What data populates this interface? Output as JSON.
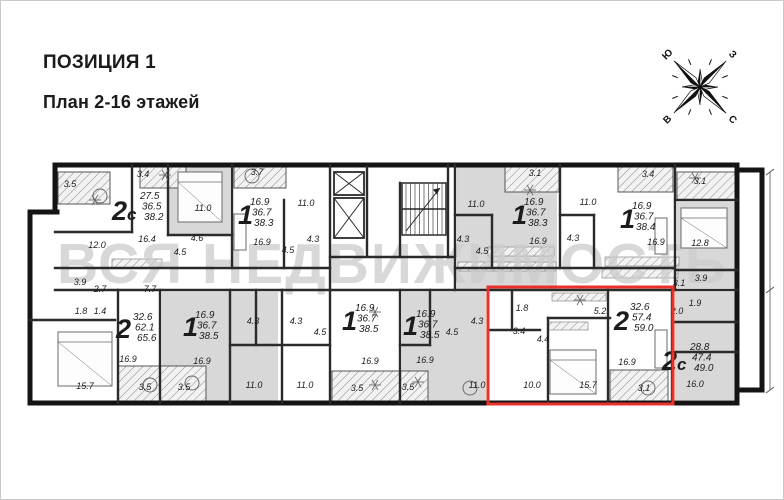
{
  "header": {
    "title": "ПОЗИЦИЯ 1",
    "subtitle": "План 2-16 этажей"
  },
  "watermark": {
    "text": "ВСЯ НЕДВИЖИМОСТЬ"
  },
  "compass": {
    "letters": [
      {
        "t": "Ю",
        "a": 315
      },
      {
        "t": "З",
        "a": 45
      },
      {
        "t": "В",
        "a": 225
      },
      {
        "t": "С",
        "a": 135
      }
    ]
  },
  "colors": {
    "wall": "#141414",
    "thin": "#2a2a2a",
    "room_shade": "#d8d8d8",
    "hatch": "#8a8a8a",
    "red": "#e8312a",
    "watermark": "#cccccc",
    "label": "#1c1c1c",
    "furn": "#6a6a6a"
  },
  "plan": {
    "highlight": {
      "x": 488,
      "y": 287,
      "w": 185,
      "h": 117
    },
    "apartments": [
      {
        "id": "apt-2c-top-left",
        "type": "2с",
        "tx": 112,
        "ty": 220,
        "ax": 140,
        "ay": 199,
        "areas": [
          "27.5",
          "36.5",
          "38.2"
        ]
      },
      {
        "id": "apt-1-top-2",
        "type": "1",
        "tx": 238,
        "ty": 224,
        "ax": 250,
        "ay": 205,
        "areas": [
          "16.9",
          "36.7",
          "38.3"
        ]
      },
      {
        "id": "apt-1-top-3",
        "type": "1",
        "tx": 512,
        "ty": 224,
        "ax": 524,
        "ay": 205,
        "areas": [
          "16.9",
          "36.7",
          "38.3"
        ]
      },
      {
        "id": "apt-1-top-4",
        "type": "1",
        "tx": 620,
        "ty": 228,
        "ax": 632,
        "ay": 209,
        "areas": [
          "16.9",
          "36.7",
          "38.4"
        ]
      },
      {
        "id": "apt-2c-right",
        "type": "2с",
        "tx": 662,
        "ty": 370,
        "ax": 690,
        "ay": 350,
        "areas": [
          "28.8",
          "47.4",
          "49.0"
        ]
      },
      {
        "id": "apt-2-bottom-left",
        "type": "2",
        "tx": 116,
        "ty": 338,
        "ax": 133,
        "ay": 320,
        "areas": [
          "32.6",
          "62.1",
          "65.6"
        ]
      },
      {
        "id": "apt-1-bottom-1",
        "type": "1",
        "tx": 183,
        "ty": 336,
        "ax": 195,
        "ay": 318,
        "areas": [
          "16.9",
          "36.7",
          "38.5"
        ]
      },
      {
        "id": "apt-1-bottom-2",
        "type": "1",
        "tx": 342,
        "ty": 330,
        "ax": 355,
        "ay": 311,
        "areas": [
          "16.9",
          "36.7",
          "38.5"
        ]
      },
      {
        "id": "apt-1-bottom-3",
        "type": "1",
        "tx": 403,
        "ty": 335,
        "ax": 416,
        "ay": 317,
        "areas": [
          "16.9",
          "36.7",
          "38.5"
        ]
      },
      {
        "id": "apt-2-highlighted",
        "type": "2",
        "tx": 614,
        "ty": 330,
        "ax": 630,
        "ay": 310,
        "areas": [
          "32.6",
          "57.4",
          "59.0"
        ]
      }
    ],
    "room_labels": [
      {
        "t": "3.5",
        "x": 70,
        "y": 187
      },
      {
        "t": "3.4",
        "x": 143,
        "y": 177
      },
      {
        "t": "11.0",
        "x": 203,
        "y": 211
      },
      {
        "t": "12.0",
        "x": 97,
        "y": 248
      },
      {
        "t": "16.4",
        "x": 147,
        "y": 242
      },
      {
        "t": "4.6",
        "x": 197,
        "y": 241
      },
      {
        "t": "4.5",
        "x": 180,
        "y": 255
      },
      {
        "t": "3.7",
        "x": 257,
        "y": 175
      },
      {
        "t": "11.0",
        "x": 306,
        "y": 206
      },
      {
        "t": "16.9",
        "x": 262,
        "y": 245
      },
      {
        "t": "4.3",
        "x": 313,
        "y": 242
      },
      {
        "t": "4.5",
        "x": 288,
        "y": 253
      },
      {
        "t": "3.1",
        "x": 535,
        "y": 176
      },
      {
        "t": "11.0",
        "x": 476,
        "y": 207
      },
      {
        "t": "4.3",
        "x": 463,
        "y": 242
      },
      {
        "t": "4.5",
        "x": 482,
        "y": 254
      },
      {
        "t": "16.9",
        "x": 538,
        "y": 244
      },
      {
        "t": "3.4",
        "x": 648,
        "y": 177
      },
      {
        "t": "11.0",
        "x": 588,
        "y": 205
      },
      {
        "t": "4.3",
        "x": 573,
        "y": 241
      },
      {
        "t": "16.9",
        "x": 656,
        "y": 245
      },
      {
        "t": "3.1",
        "x": 700,
        "y": 184
      },
      {
        "t": "12.8",
        "x": 700,
        "y": 246
      },
      {
        "t": "3.9",
        "x": 701,
        "y": 281
      },
      {
        "t": "3.9",
        "x": 80,
        "y": 285
      },
      {
        "t": "2.7",
        "x": 100,
        "y": 292
      },
      {
        "t": "7.7",
        "x": 150,
        "y": 292
      },
      {
        "t": "1.8",
        "x": 81,
        "y": 314
      },
      {
        "t": "1.4",
        "x": 100,
        "y": 314
      },
      {
        "t": "15.7",
        "x": 85,
        "y": 389
      },
      {
        "t": "16.9",
        "x": 128,
        "y": 362
      },
      {
        "t": "3.5",
        "x": 145,
        "y": 390
      },
      {
        "t": "16.9",
        "x": 202,
        "y": 364
      },
      {
        "t": "3.5",
        "x": 184,
        "y": 390
      },
      {
        "t": "4.3",
        "x": 253,
        "y": 324
      },
      {
        "t": "4.3",
        "x": 296,
        "y": 324
      },
      {
        "t": "4.5",
        "x": 320,
        "y": 335
      },
      {
        "t": "11.0",
        "x": 254,
        "y": 388
      },
      {
        "t": "11.0",
        "x": 305,
        "y": 388
      },
      {
        "t": "16.9",
        "x": 370,
        "y": 364
      },
      {
        "t": "3.5",
        "x": 357,
        "y": 391
      },
      {
        "t": "3.5",
        "x": 408,
        "y": 390
      },
      {
        "t": "4.3",
        "x": 477,
        "y": 324
      },
      {
        "t": "4.5",
        "x": 452,
        "y": 335
      },
      {
        "t": "16.9",
        "x": 425,
        "y": 363
      },
      {
        "t": "11.0",
        "x": 477,
        "y": 388
      },
      {
        "t": "1.8",
        "x": 522,
        "y": 311
      },
      {
        "t": "3.4",
        "x": 519,
        "y": 334
      },
      {
        "t": "4.4",
        "x": 543,
        "y": 342
      },
      {
        "t": "5.2",
        "x": 600,
        "y": 314
      },
      {
        "t": "10.0",
        "x": 532,
        "y": 388
      },
      {
        "t": "15.7",
        "x": 588,
        "y": 388
      },
      {
        "t": "16.9",
        "x": 627,
        "y": 365
      },
      {
        "t": "3.1",
        "x": 644,
        "y": 391
      },
      {
        "t": "3.1",
        "x": 679,
        "y": 286
      },
      {
        "t": "1.9",
        "x": 695,
        "y": 306
      },
      {
        "t": "2.0",
        "x": 677,
        "y": 314
      },
      {
        "t": "16.0",
        "x": 695,
        "y": 387
      }
    ],
    "gray_rooms": [
      [
        168,
        167,
        62,
        67
      ],
      [
        457,
        167,
        100,
        122
      ],
      [
        677,
        202,
        58,
        86
      ],
      [
        675,
        292,
        60,
        108
      ],
      [
        162,
        292,
        116,
        110
      ],
      [
        402,
        292,
        84,
        110
      ]
    ],
    "balconies": [
      [
        58,
        172,
        52,
        32
      ],
      [
        140,
        166,
        46,
        22
      ],
      [
        234,
        166,
        52,
        22
      ],
      [
        505,
        166,
        54,
        26
      ],
      [
        618,
        166,
        55,
        26
      ],
      [
        677,
        172,
        58,
        28
      ],
      [
        118,
        366,
        88,
        37
      ],
      [
        332,
        371,
        96,
        32
      ],
      [
        610,
        370,
        58,
        33
      ]
    ],
    "hatch_strips": [
      [
        112,
        259,
        50,
        9
      ],
      [
        488,
        247,
        66,
        9
      ],
      [
        458,
        262,
        98,
        9
      ],
      [
        605,
        257,
        74,
        9
      ],
      [
        602,
        269,
        76,
        9
      ],
      [
        552,
        293,
        54,
        8
      ],
      [
        548,
        322,
        40,
        8
      ]
    ],
    "walls_thick": [
      [
        55,
        165,
        737,
        165
      ],
      [
        55,
        165,
        55,
        212
      ],
      [
        30,
        212,
        57,
        212
      ],
      [
        30,
        212,
        30,
        403
      ],
      [
        30,
        403,
        737,
        403
      ],
      [
        737,
        165,
        737,
        403
      ],
      [
        737,
        170,
        762,
        170
      ],
      [
        762,
        170,
        762,
        390
      ],
      [
        737,
        390,
        762,
        390
      ]
    ],
    "walls_thin": [
      [
        132,
        165,
        132,
        232
      ],
      [
        55,
        232,
        132,
        232
      ],
      [
        168,
        165,
        168,
        235
      ],
      [
        168,
        235,
        232,
        235
      ],
      [
        232,
        165,
        232,
        268
      ],
      [
        284,
        200,
        284,
        268
      ],
      [
        330,
        165,
        330,
        290
      ],
      [
        367,
        167,
        367,
        255
      ],
      [
        400,
        183,
        400,
        257
      ],
      [
        448,
        165,
        448,
        257
      ],
      [
        330,
        257,
        455,
        257
      ],
      [
        455,
        165,
        455,
        290
      ],
      [
        455,
        215,
        492,
        215
      ],
      [
        492,
        215,
        492,
        268
      ],
      [
        560,
        165,
        560,
        268
      ],
      [
        560,
        215,
        594,
        215
      ],
      [
        594,
        215,
        594,
        268
      ],
      [
        675,
        165,
        675,
        290
      ],
      [
        675,
        200,
        737,
        200
      ],
      [
        55,
        268,
        330,
        268
      ],
      [
        455,
        268,
        675,
        268
      ],
      [
        55,
        290,
        737,
        290
      ],
      [
        675,
        270,
        737,
        270
      ],
      [
        675,
        322,
        737,
        322
      ],
      [
        675,
        352,
        737,
        352
      ],
      [
        118,
        290,
        118,
        403
      ],
      [
        30,
        320,
        115,
        320
      ],
      [
        160,
        290,
        160,
        403
      ],
      [
        230,
        290,
        230,
        403
      ],
      [
        256,
        290,
        256,
        345
      ],
      [
        230,
        345,
        330,
        345
      ],
      [
        282,
        290,
        282,
        403
      ],
      [
        330,
        290,
        330,
        403
      ],
      [
        400,
        290,
        400,
        403
      ],
      [
        430,
        290,
        430,
        345
      ],
      [
        400,
        345,
        430,
        345
      ],
      [
        488,
        290,
        488,
        403
      ],
      [
        512,
        292,
        512,
        330
      ],
      [
        488,
        330,
        540,
        330
      ],
      [
        548,
        318,
        548,
        403
      ],
      [
        548,
        318,
        610,
        318
      ],
      [
        608,
        290,
        608,
        403
      ],
      [
        672,
        290,
        672,
        403
      ]
    ],
    "elevators": [
      [
        334,
        172,
        30,
        23
      ],
      [
        334,
        198,
        30,
        40
      ]
    ],
    "stairs": {
      "x": 402,
      "y": 183,
      "w": 44,
      "h": 52
    },
    "dimension_line": {
      "x": 770,
      "y1": 172,
      "y2": 390,
      "ticks": [
        172,
        290,
        390
      ]
    },
    "furniture": {
      "beds": [
        [
          178,
          172,
          44,
          50
        ],
        [
          681,
          208,
          46,
          40
        ],
        [
          58,
          332,
          54,
          54
        ],
        [
          550,
          350,
          46,
          44
        ]
      ],
      "tables": [
        [
          150,
          385
        ],
        [
          192,
          383
        ],
        [
          470,
          388
        ],
        [
          648,
          388
        ],
        [
          100,
          196
        ],
        [
          252,
          176
        ]
      ],
      "sofas": [
        [
          234,
          214,
          12,
          36
        ],
        [
          655,
          218,
          12,
          36
        ],
        [
          655,
          330,
          12,
          38
        ]
      ],
      "plants": [
        [
          165,
          175
        ],
        [
          95,
          200
        ],
        [
          530,
          190
        ],
        [
          695,
          178
        ],
        [
          375,
          385
        ],
        [
          418,
          382
        ],
        [
          580,
          300
        ],
        [
          375,
          312
        ]
      ]
    }
  }
}
